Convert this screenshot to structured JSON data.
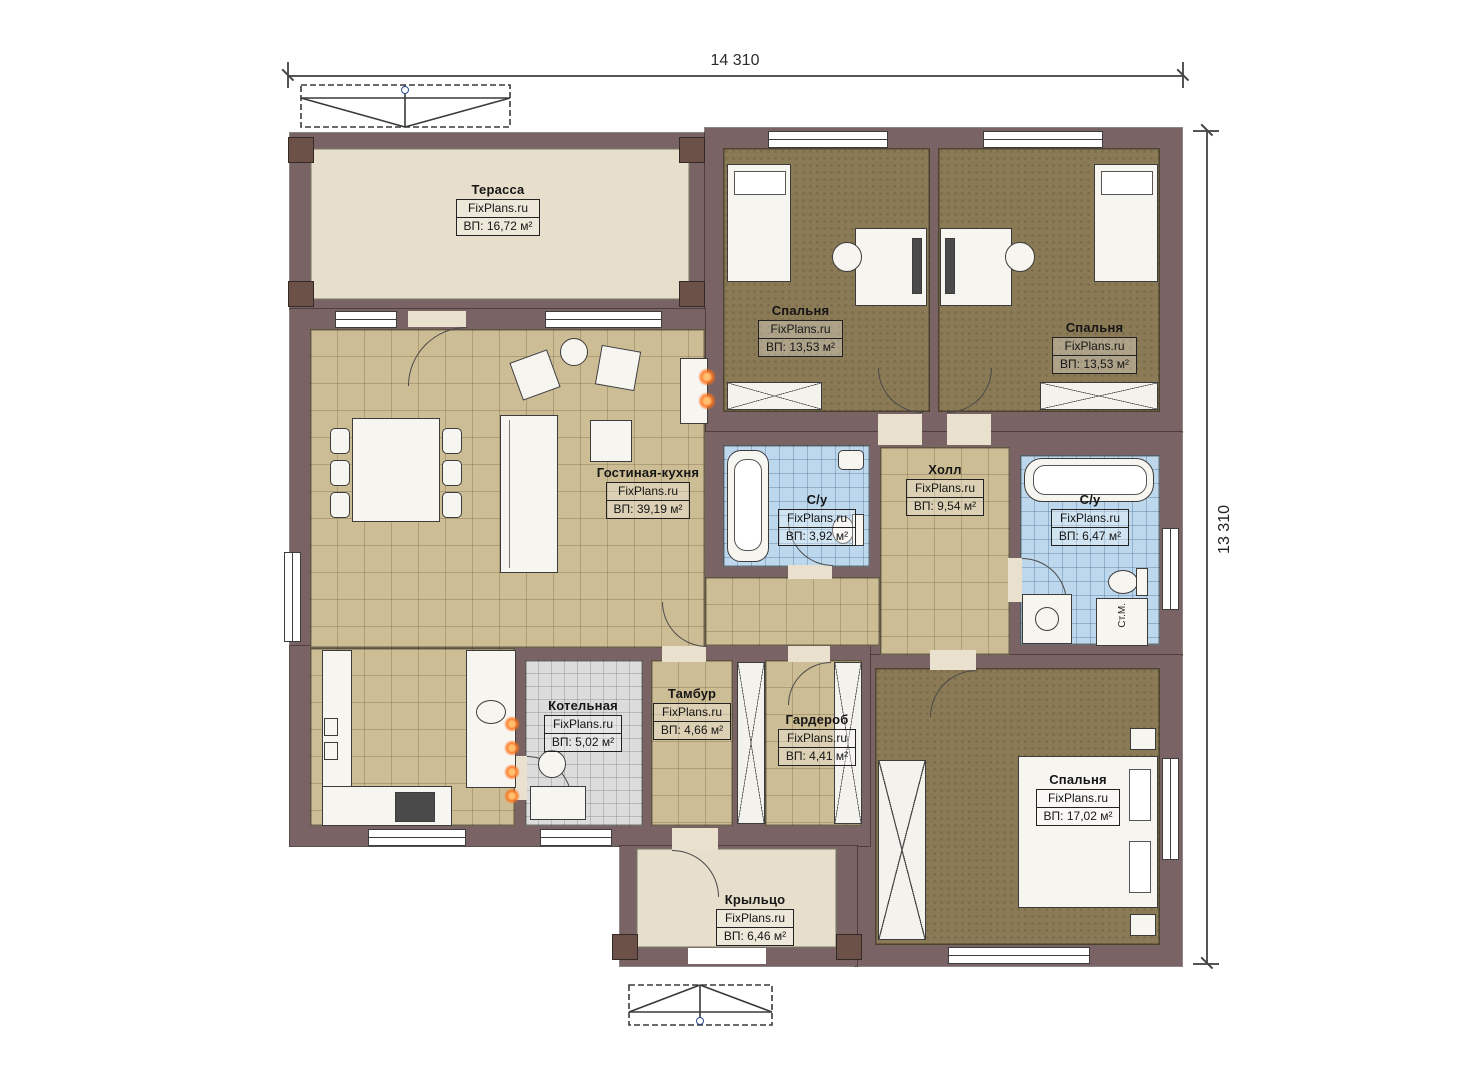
{
  "page": {
    "type": "floor-plan",
    "background": "#ffffff"
  },
  "brand": "FixPlans.ru",
  "dimensions": {
    "top": "14 310",
    "right": "13 310"
  },
  "rooms": [
    {
      "name": "Терасса",
      "brand": "FixPlans.ru",
      "area": "ВП: 16,72 м²"
    },
    {
      "name": "Спальня",
      "brand": "FixPlans.ru",
      "area": "ВП: 13,53 м²"
    },
    {
      "name": "Спальня",
      "brand": "FixPlans.ru",
      "area": "ВП: 13,53 м²"
    },
    {
      "name": "Гостиная-кухня",
      "brand": "FixPlans.ru",
      "area": "ВП: 39,19 м²"
    },
    {
      "name": "С/у",
      "brand": "FixPlans.ru",
      "area": "ВП: 3,92 м²"
    },
    {
      "name": "Холл",
      "brand": "FixPlans.ru",
      "area": "ВП: 9,54 м²"
    },
    {
      "name": "С/у",
      "brand": "FixPlans.ru",
      "area": "ВП: 6,47 м²"
    },
    {
      "name": "Котельная",
      "brand": "FixPlans.ru",
      "area": "ВП: 5,02 м²"
    },
    {
      "name": "Тамбур",
      "brand": "FixPlans.ru",
      "area": "ВП: 4,66 м²"
    },
    {
      "name": "Гардероб",
      "brand": "FixPlans.ru",
      "area": "ВП: 4,41 м²"
    },
    {
      "name": "Спальня",
      "brand": "FixPlans.ru",
      "area": "ВП: 17,02 м²"
    },
    {
      "name": "Крыльцо",
      "brand": "FixPlans.ru",
      "area": "ВП: 6,46 м²"
    }
  ],
  "annotations": {
    "washing_machine": "Ст.М."
  },
  "colors": {
    "wall": "#7a6364",
    "floor_terrace": "#e7decb",
    "floor_bedroom": "#8b7a56",
    "floor_tile_tan": "#cdbd94",
    "floor_tile_blue": "#bdd8ec",
    "floor_tile_gray": "#dcdcdc",
    "fire_accent": "#ff6e14"
  }
}
